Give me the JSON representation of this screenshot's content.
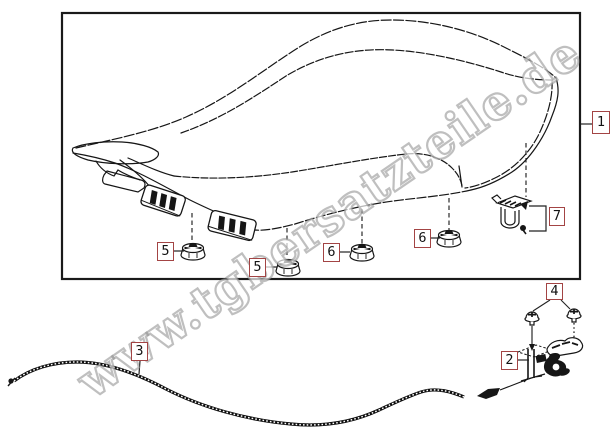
{
  "watermark": {
    "text": "www.tgbersatzteile.de"
  },
  "diagram": {
    "type": "exploded-parts-diagram",
    "subject": "seat-assembly",
    "frame_color": "#1a1a1a",
    "line_color": "#161616",
    "callout_border_color": "#a34444",
    "callouts": [
      {
        "ref": "1"
      },
      {
        "ref": "2"
      },
      {
        "ref": "3"
      },
      {
        "ref": "4"
      },
      {
        "ref": "5"
      },
      {
        "ref": "5"
      },
      {
        "ref": "6"
      },
      {
        "ref": "6"
      },
      {
        "ref": "7"
      }
    ]
  }
}
